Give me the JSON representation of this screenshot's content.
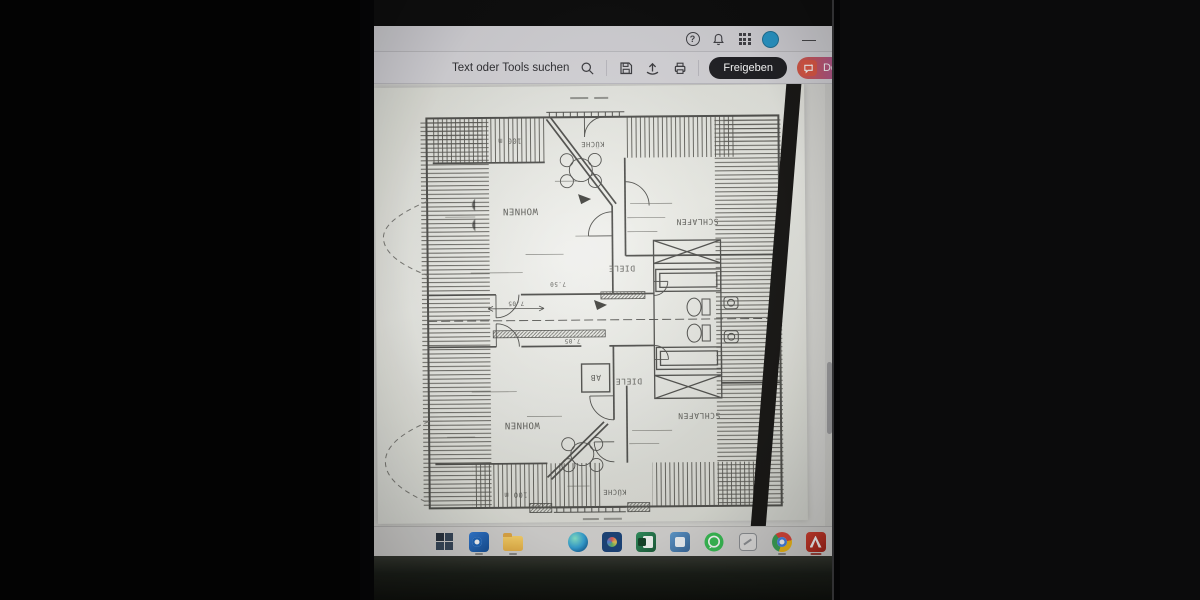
{
  "window": {
    "app": "pdf-viewer",
    "titlebar": {
      "help_label": "?",
      "minimize_label": "—",
      "icons": [
        "help",
        "notifications",
        "apps-grid",
        "account",
        "minimize"
      ],
      "avatar_color": "#1f99cf"
    },
    "toolbar": {
      "search_label": "Text oder Tools suchen",
      "icons": [
        "search",
        "save",
        "share-upload",
        "print"
      ],
      "share_button": "Freigeben",
      "share_bg": "#1e1e22",
      "ai_button": "Den KI-Assistent",
      "ai_accent": "#e8543f"
    }
  },
  "document": {
    "type": "scanned-floorplan",
    "paper": "#eaebe4",
    "ink": "#3c3c38",
    "floorplan": {
      "orientation": "rotated-180",
      "labels": [
        {
          "text": "100 m"
        },
        {
          "text": "KÜCHE"
        },
        {
          "text": "WOHNEN"
        },
        {
          "text": "SCHLAFEN"
        },
        {
          "text": "DIELE"
        },
        {
          "text": "AB"
        },
        {
          "text": "DIELE"
        },
        {
          "text": "WOHNEN"
        },
        {
          "text": "SCHLAFEN"
        },
        {
          "text": "KÜCHE"
        },
        {
          "text": "100 m"
        }
      ],
      "dimensions": [
        "7.05",
        "7.05",
        "7.50"
      ]
    }
  },
  "taskbar": {
    "apps": [
      {
        "name": "windows-start",
        "color": "#35475c"
      },
      {
        "name": "outlook",
        "color": "#1e6fd0"
      },
      {
        "name": "file-explorer",
        "color": "#f0c04a"
      },
      {
        "name": "edge",
        "color": "#2aa0d8"
      },
      {
        "name": "photos",
        "color": "#16427e"
      },
      {
        "name": "excel",
        "color": "#1f7a44"
      },
      {
        "name": "teams",
        "color": "#4a84bd"
      },
      {
        "name": "whatsapp",
        "color": "#2fc14d"
      },
      {
        "name": "snipping-tool",
        "color": "#b9bcc0"
      },
      {
        "name": "chrome",
        "color": "#ea4335"
      },
      {
        "name": "acrobat-reader",
        "color": "#cf2418"
      }
    ]
  }
}
